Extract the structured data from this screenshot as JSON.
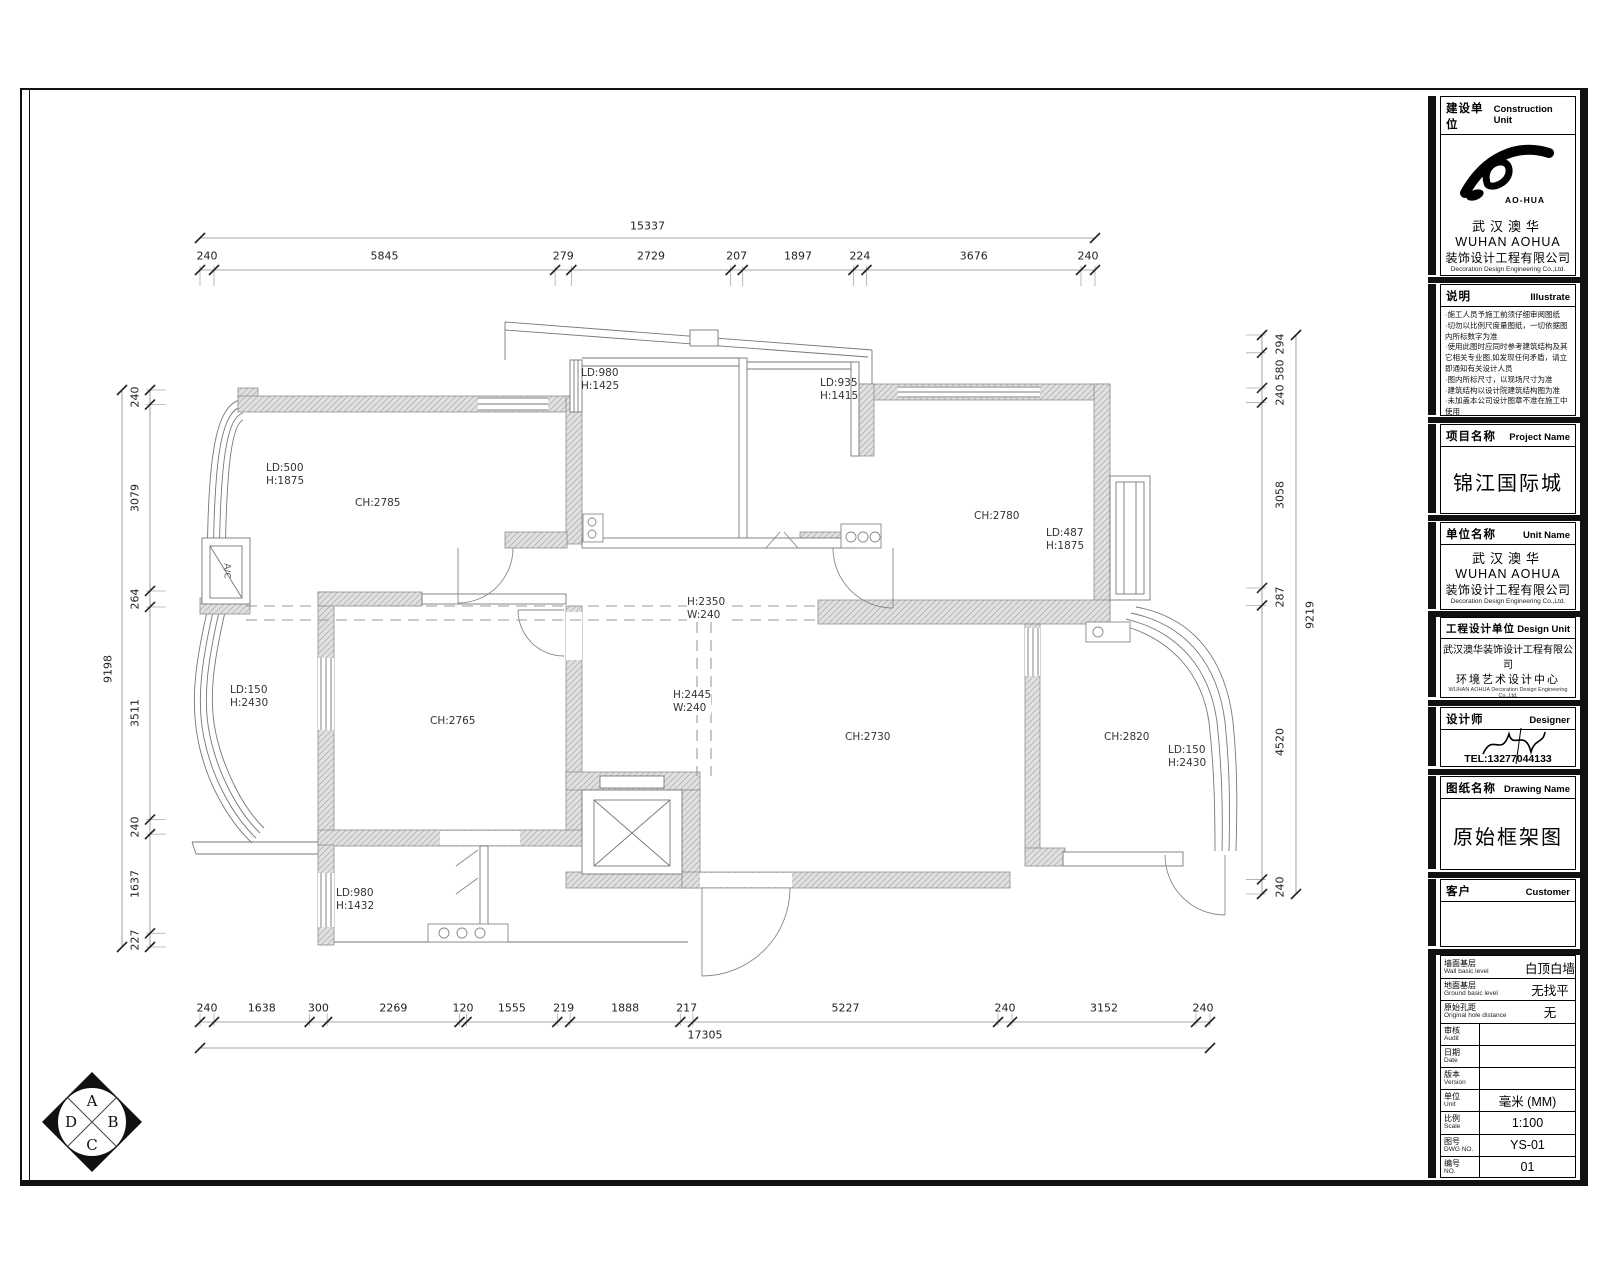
{
  "title_block": {
    "construction_unit": {
      "label_cn": "建设单位",
      "label_en": "Construction Unit",
      "logo_text": "AO-HUA",
      "company_cn_short": "武汉澳华",
      "company_en_short": "WUHAN AOHUA",
      "company_cn": "装饰设计工程有限公司",
      "company_en": "Decoration Design Engineering Co.,Ltd."
    },
    "illustrate": {
      "label_cn": "说明",
      "label_en": "Illustrate",
      "lines": [
        "·施工人员予施工前须仔细审阅图纸",
        "·切勿以比例尺度量图纸，一切依据图",
        "  内所标数字为准",
        "·使用此图时应同时参考建筑结构及其",
        "  它相关专业图,如发现任何矛盾，请立",
        "  即通知有关设计人员",
        "·图内所标尺寸，以现场尺寸为准",
        "·建筑结构以设计院建筑结构图为准",
        "·未加盖本公司设计图章不准在施工中",
        "  使用"
      ]
    },
    "project": {
      "label_cn": "项目名称",
      "label_en": "Project Name",
      "value": "锦江国际城"
    },
    "unit": {
      "label_cn": "单位名称",
      "label_en": "Unit Name",
      "company_cn_short": "武汉澳华",
      "company_en_short": "WUHAN AOHUA",
      "company_cn": "装饰设计工程有限公司",
      "company_en": "Decoration Design Engineering Co.,Ltd."
    },
    "design_unit": {
      "label_cn": "工程设计单位",
      "label_en": "Design Unit",
      "line1": "武汉澳华装饰设计工程有限公司",
      "line2": "环境艺术设计中心",
      "line3": "WUHAN AOHUA Decoration Design Engineering Co.,Ltd.",
      "line4": "Environmental Art Design Center"
    },
    "designer": {
      "label_cn": "设计师",
      "label_en": "Designer",
      "tel": "TEL:13277044133"
    },
    "drawing": {
      "label_cn": "图纸名称",
      "label_en": "Drawing Name",
      "value": "原始框架图"
    },
    "customer": {
      "label_cn": "客户",
      "label_en": "Customer",
      "value": ""
    },
    "table": {
      "rows": [
        {
          "cn": "墙面基层",
          "en": "Wall basic level",
          "value": "白顶白墙",
          "divider": false
        },
        {
          "cn": "地面基层",
          "en": "Ground basic level",
          "value": "无找平",
          "divider": false
        },
        {
          "cn": "原始孔距",
          "en": "Original hole distance",
          "value": "无",
          "divider": false
        },
        {
          "cn": "审核",
          "en": "Audit",
          "value": "",
          "divider": true
        },
        {
          "cn": "日期",
          "en": "Date",
          "value": "",
          "divider": true
        },
        {
          "cn": "版本",
          "en": "Version",
          "value": "",
          "divider": true
        },
        {
          "cn": "单位",
          "en": "Unit",
          "value": "毫米 (MM)",
          "divider": true
        },
        {
          "cn": "比例",
          "en": "Scale",
          "value": "1:100",
          "divider": true
        },
        {
          "cn": "图号",
          "en": "DWG NO.",
          "value": "YS-01",
          "divider": true
        },
        {
          "cn": "编号",
          "en": "NO.",
          "value": "01",
          "divider": true
        }
      ]
    }
  },
  "dimensions": {
    "top": {
      "segments": [
        240,
        5845,
        279,
        2729,
        207,
        1897,
        224,
        3676,
        240
      ],
      "total": 15337
    },
    "bottom": {
      "segments": [
        240,
        1638,
        300,
        2269,
        120,
        1555,
        219,
        1888,
        217,
        5227,
        240,
        3152,
        240
      ],
      "total": 17305
    },
    "left": {
      "segments": [
        240,
        3079,
        264,
        3511,
        240,
        1637,
        227
      ],
      "total": 9198
    },
    "right": {
      "segments": [
        294,
        580,
        240,
        3058,
        287,
        4520,
        240
      ],
      "total": 9219
    }
  },
  "plan": {
    "room_labels": {
      "ch2785": "CH:2785",
      "ch2780": "CH:2780",
      "ch2765": "CH:2765",
      "ch2730": "CH:2730",
      "ch2820": "CH:2820"
    },
    "window_labels": {
      "tl": {
        "l1": "LD:500",
        "l2": "H:1875"
      },
      "kitchen": {
        "l1": "LD:980",
        "l2": "H:1425"
      },
      "mid": {
        "l1": "LD:935",
        "l2": "H:1415"
      },
      "tr": {
        "l1": "LD:487",
        "l2": "H:1875"
      },
      "left": {
        "l1": "LD:150",
        "l2": "H:2430"
      },
      "right": {
        "l1": "LD:150",
        "l2": "H:2430"
      },
      "bath": {
        "l1": "LD:980",
        "l2": "H:1432"
      }
    },
    "beam_labels": {
      "h": {
        "l1": "H:2350",
        "l2": "W:240"
      },
      "v": {
        "l1": "H:2445",
        "l2": "W:240"
      }
    },
    "ac_label": "A/C"
  },
  "compass": {
    "letters": {
      "a": "A",
      "b": "B",
      "c": "C",
      "d": "D"
    }
  },
  "colors": {
    "frame": "#111111",
    "wall": "#d8d8d8",
    "line": "#777777",
    "text": "#222222"
  }
}
